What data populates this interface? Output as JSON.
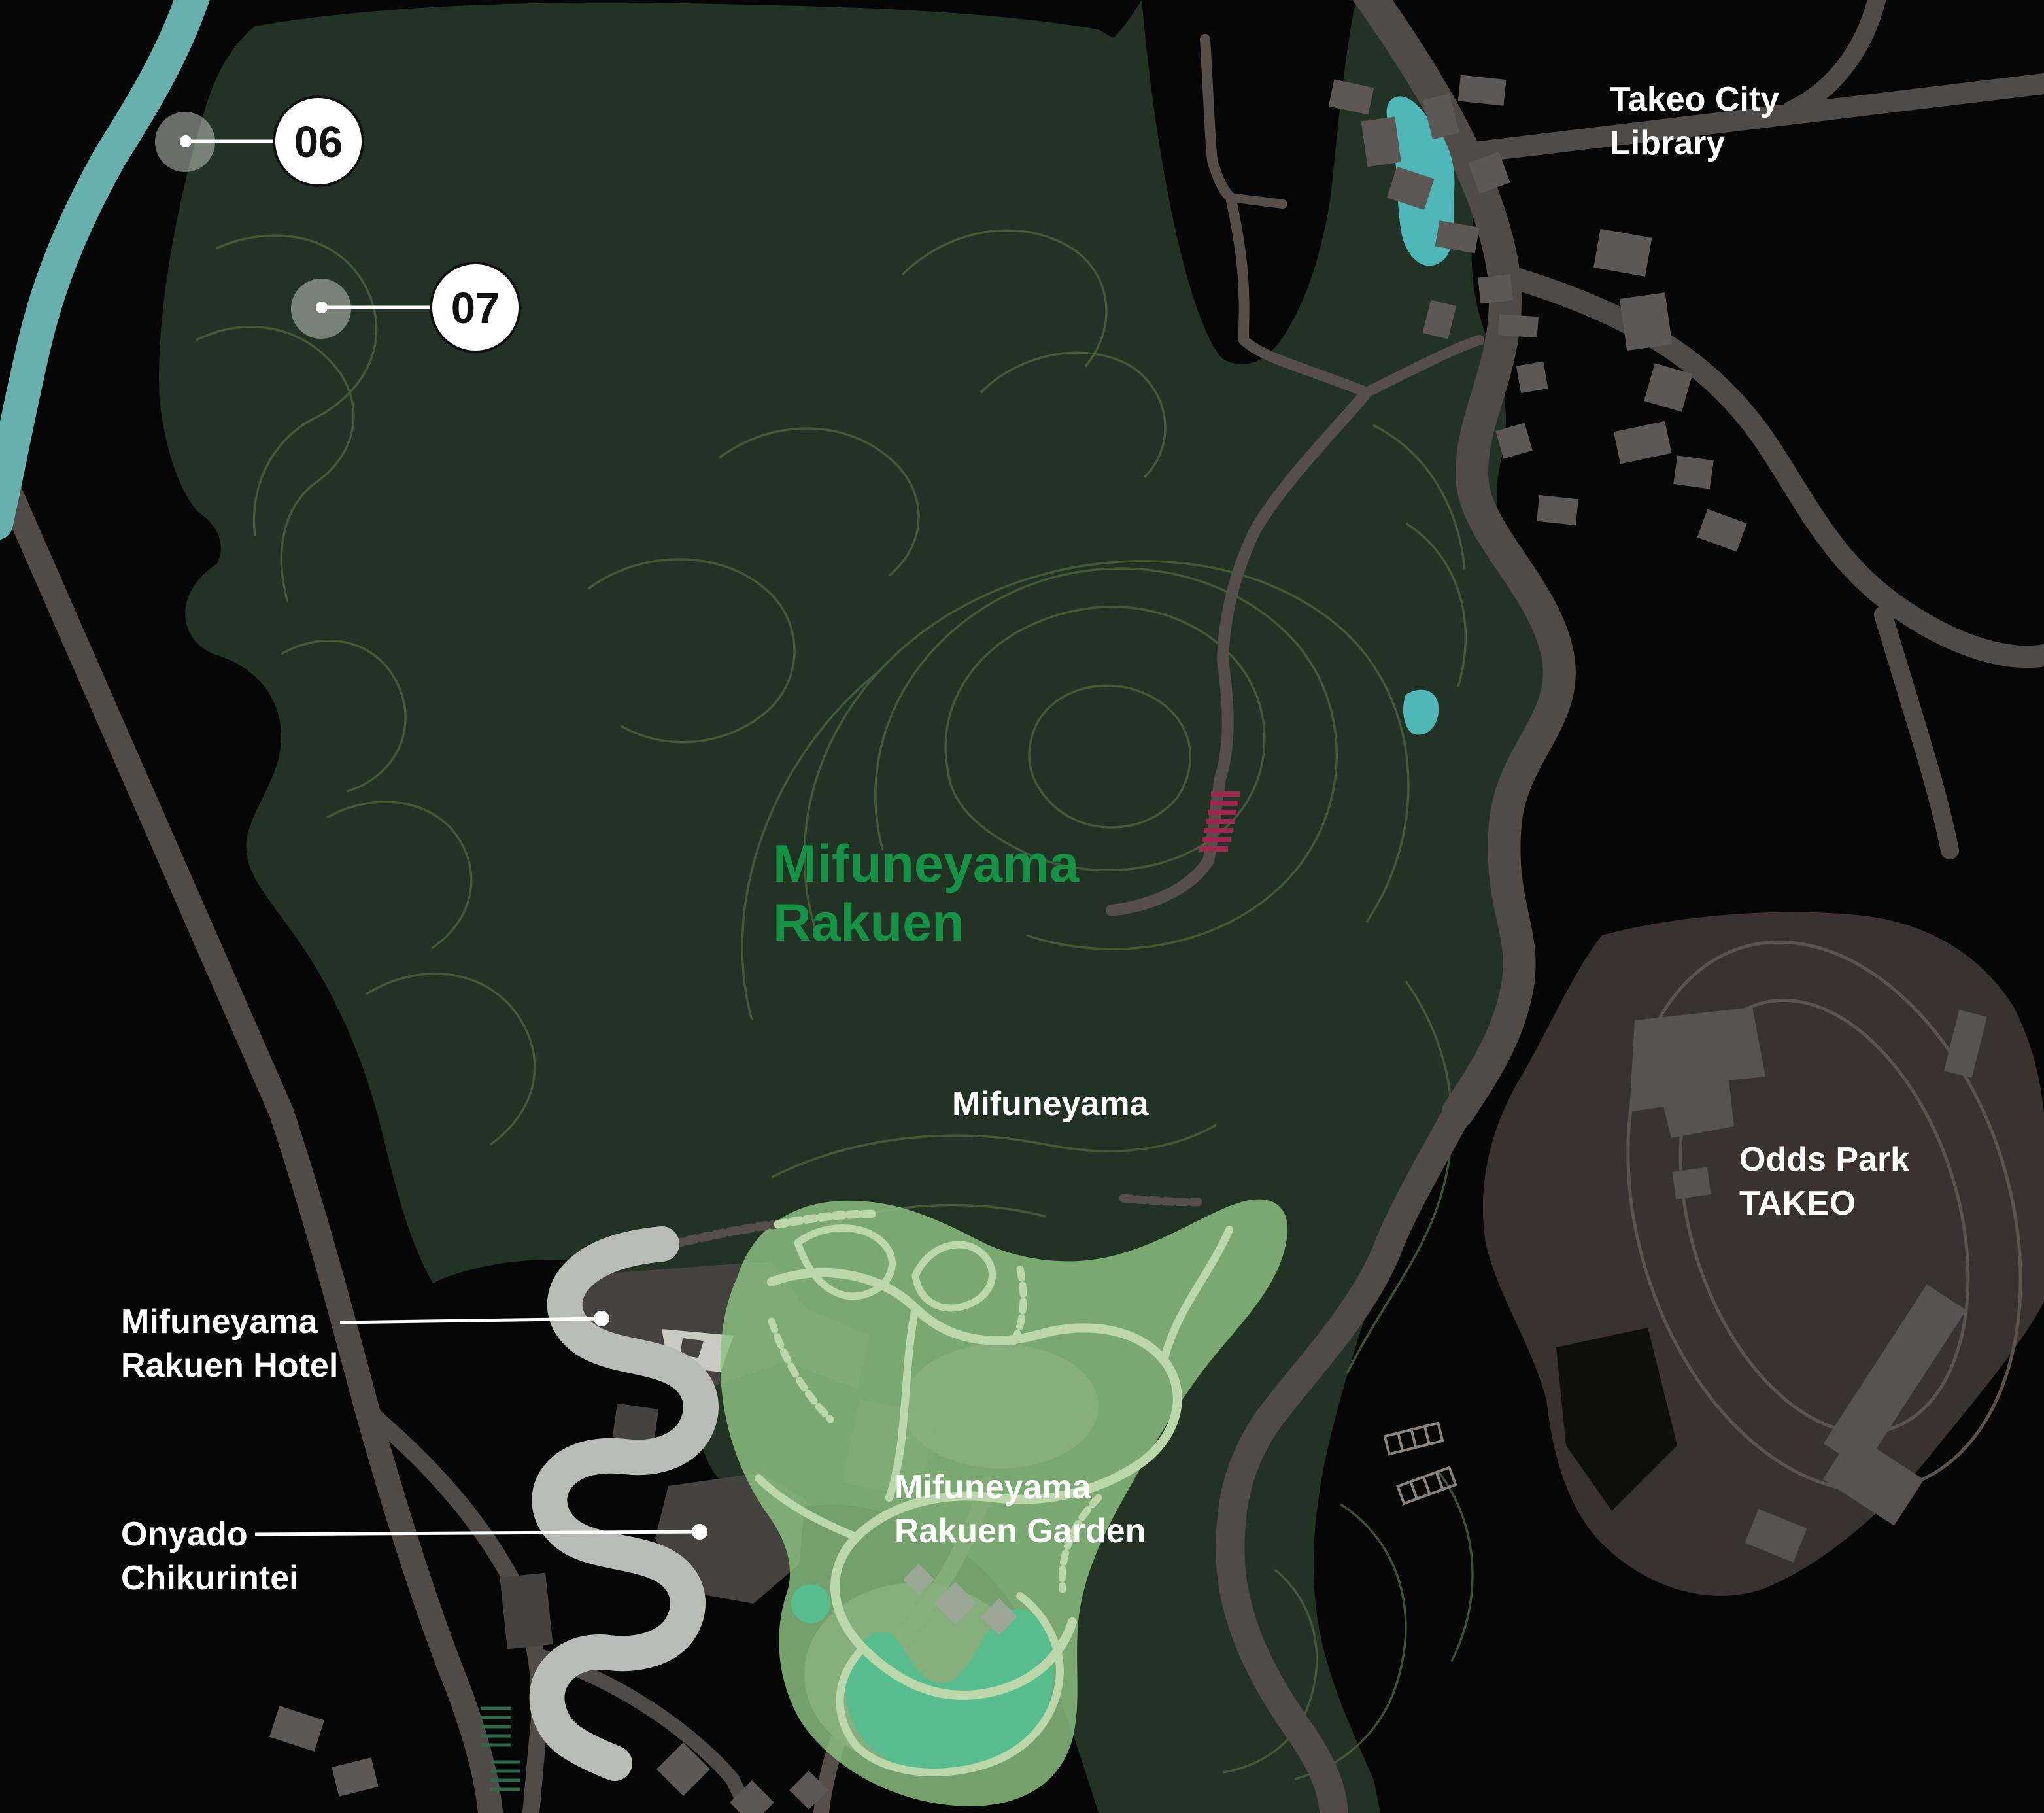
{
  "map_title": "Mifuneyama Rakuen area map",
  "labels": {
    "takeo_library": {
      "line1": "Takeo City",
      "line2": "Library"
    },
    "park_green": {
      "line1": "Mifuneyama",
      "line2": "Rakuen"
    },
    "peak": {
      "text": "Mifuneyama"
    },
    "odds_park": {
      "line1": "Odds Park",
      "line2": "TAKEO"
    },
    "hotel": {
      "line1": "Mifuneyama",
      "line2": "Rakuen Hotel"
    },
    "onyado": {
      "line1": "Onyado",
      "line2": "Chikurintei"
    },
    "garden": {
      "line1": "Mifuneyama",
      "line2": "Rakuen Garden"
    }
  },
  "markers": [
    {
      "num": "06"
    },
    {
      "num": "07"
    }
  ],
  "icons": {
    "marker_halo": "location-halo-icon",
    "marker_bubble": "numbered-pin-icon",
    "stairs": "stairs-hatch-icon"
  },
  "colors": {
    "background": "#060606",
    "forest": "#223224",
    "contour": "#49603b",
    "river": "#68b0ad",
    "pond": "#4fb7b7",
    "road": "#514b48",
    "road_light": "#b9bcb6",
    "trail": "#564e49",
    "building": "#5d5855",
    "building_dark": "#46423f",
    "garden": "#8cc281",
    "garden_path": "#bcd8ab",
    "garden_patch": "#8ab07e",
    "garden_pond": "#57bd8e",
    "odds_bg": "#393230",
    "odds_line": "#5b534e",
    "odds_building": "#585250",
    "label_white": "#ffffff",
    "label_green": "#169245",
    "marker_halo": "#cdd4cc",
    "marker_fill": "#ffffff",
    "marker_stroke": "#111111",
    "marker_text": "#111111",
    "stairs_red": "#9e2750",
    "leader": "#ffffff",
    "bamboo_hatch": "#2e6b4a",
    "parking_line": "#8a8480",
    "hotel_court": "#c9cbc3"
  }
}
